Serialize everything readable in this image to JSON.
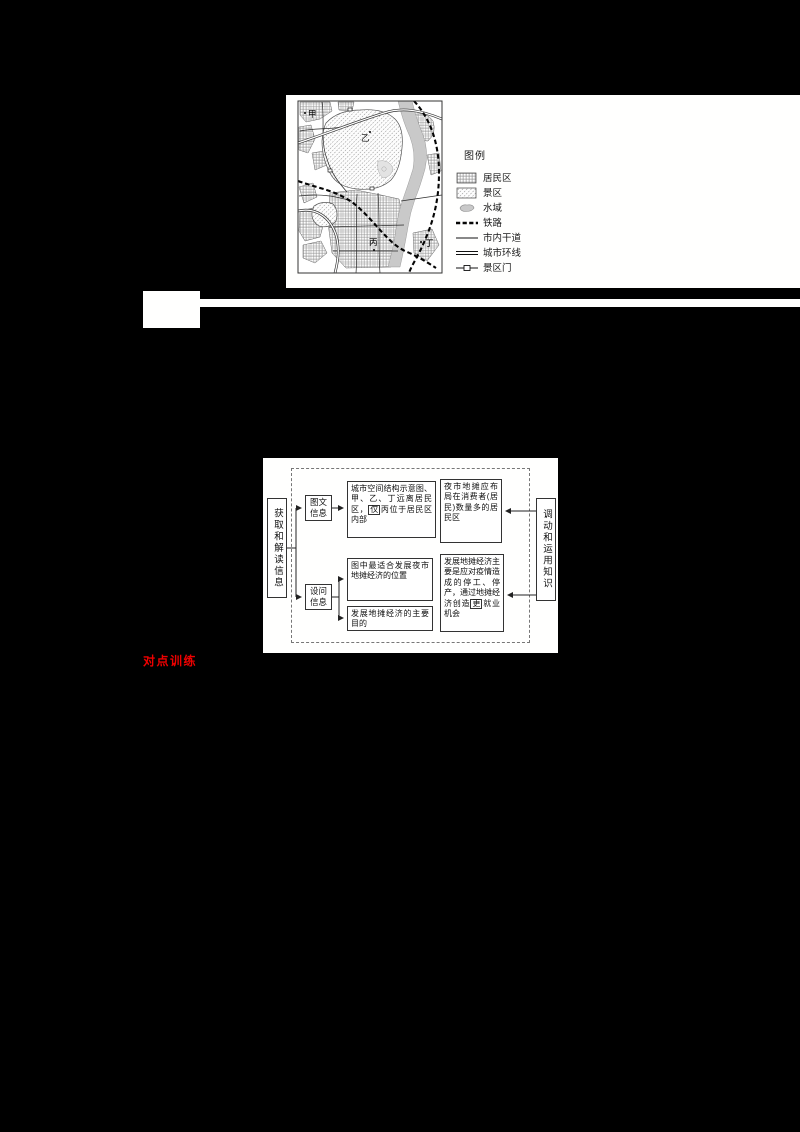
{
  "page": {
    "background": "#000000",
    "panel_background": "#fffffe",
    "accent_red": "#ee0000"
  },
  "map_panel": {
    "legend_title": "图例",
    "legend_items": [
      {
        "name": "residential",
        "label": "居民区"
      },
      {
        "name": "scenic-area",
        "label": "景区"
      },
      {
        "name": "water",
        "label": "水域"
      },
      {
        "name": "railway",
        "label": "铁路"
      },
      {
        "name": "city-main-road",
        "label": "市内干道"
      },
      {
        "name": "city-ring-road",
        "label": "城市环线"
      },
      {
        "name": "scenic-gate",
        "label": "景区门"
      }
    ],
    "point_labels": [
      "甲",
      "乙",
      "丙",
      "丁"
    ]
  },
  "flowchart": {
    "left_label": "获取和解读信息",
    "right_label": "调动和运用知识",
    "node_image_text_info": "图文信息",
    "node_question_info": "设问信息",
    "top_middle_pre": "城市空间结构示意图、甲、乙、丁远离居民区，",
    "top_middle_boxed": "仅",
    "top_middle_post": "丙位于居民区内部",
    "top_right": "夜市地摊应布局在消费者(居民)数量多的居民区",
    "bottom_middle_1": "图中最适合发展夜市地摊经济的位置",
    "bottom_middle_2": "发展地摊经济的主要目的",
    "bottom_right_pre": "发展地摊经济主要是应对疫情造成的停工、停产，通过地摊经济创造",
    "bottom_right_boxed": "更",
    "bottom_right_post": "就业机会"
  },
  "red_heading": {
    "text": "对点训练"
  }
}
